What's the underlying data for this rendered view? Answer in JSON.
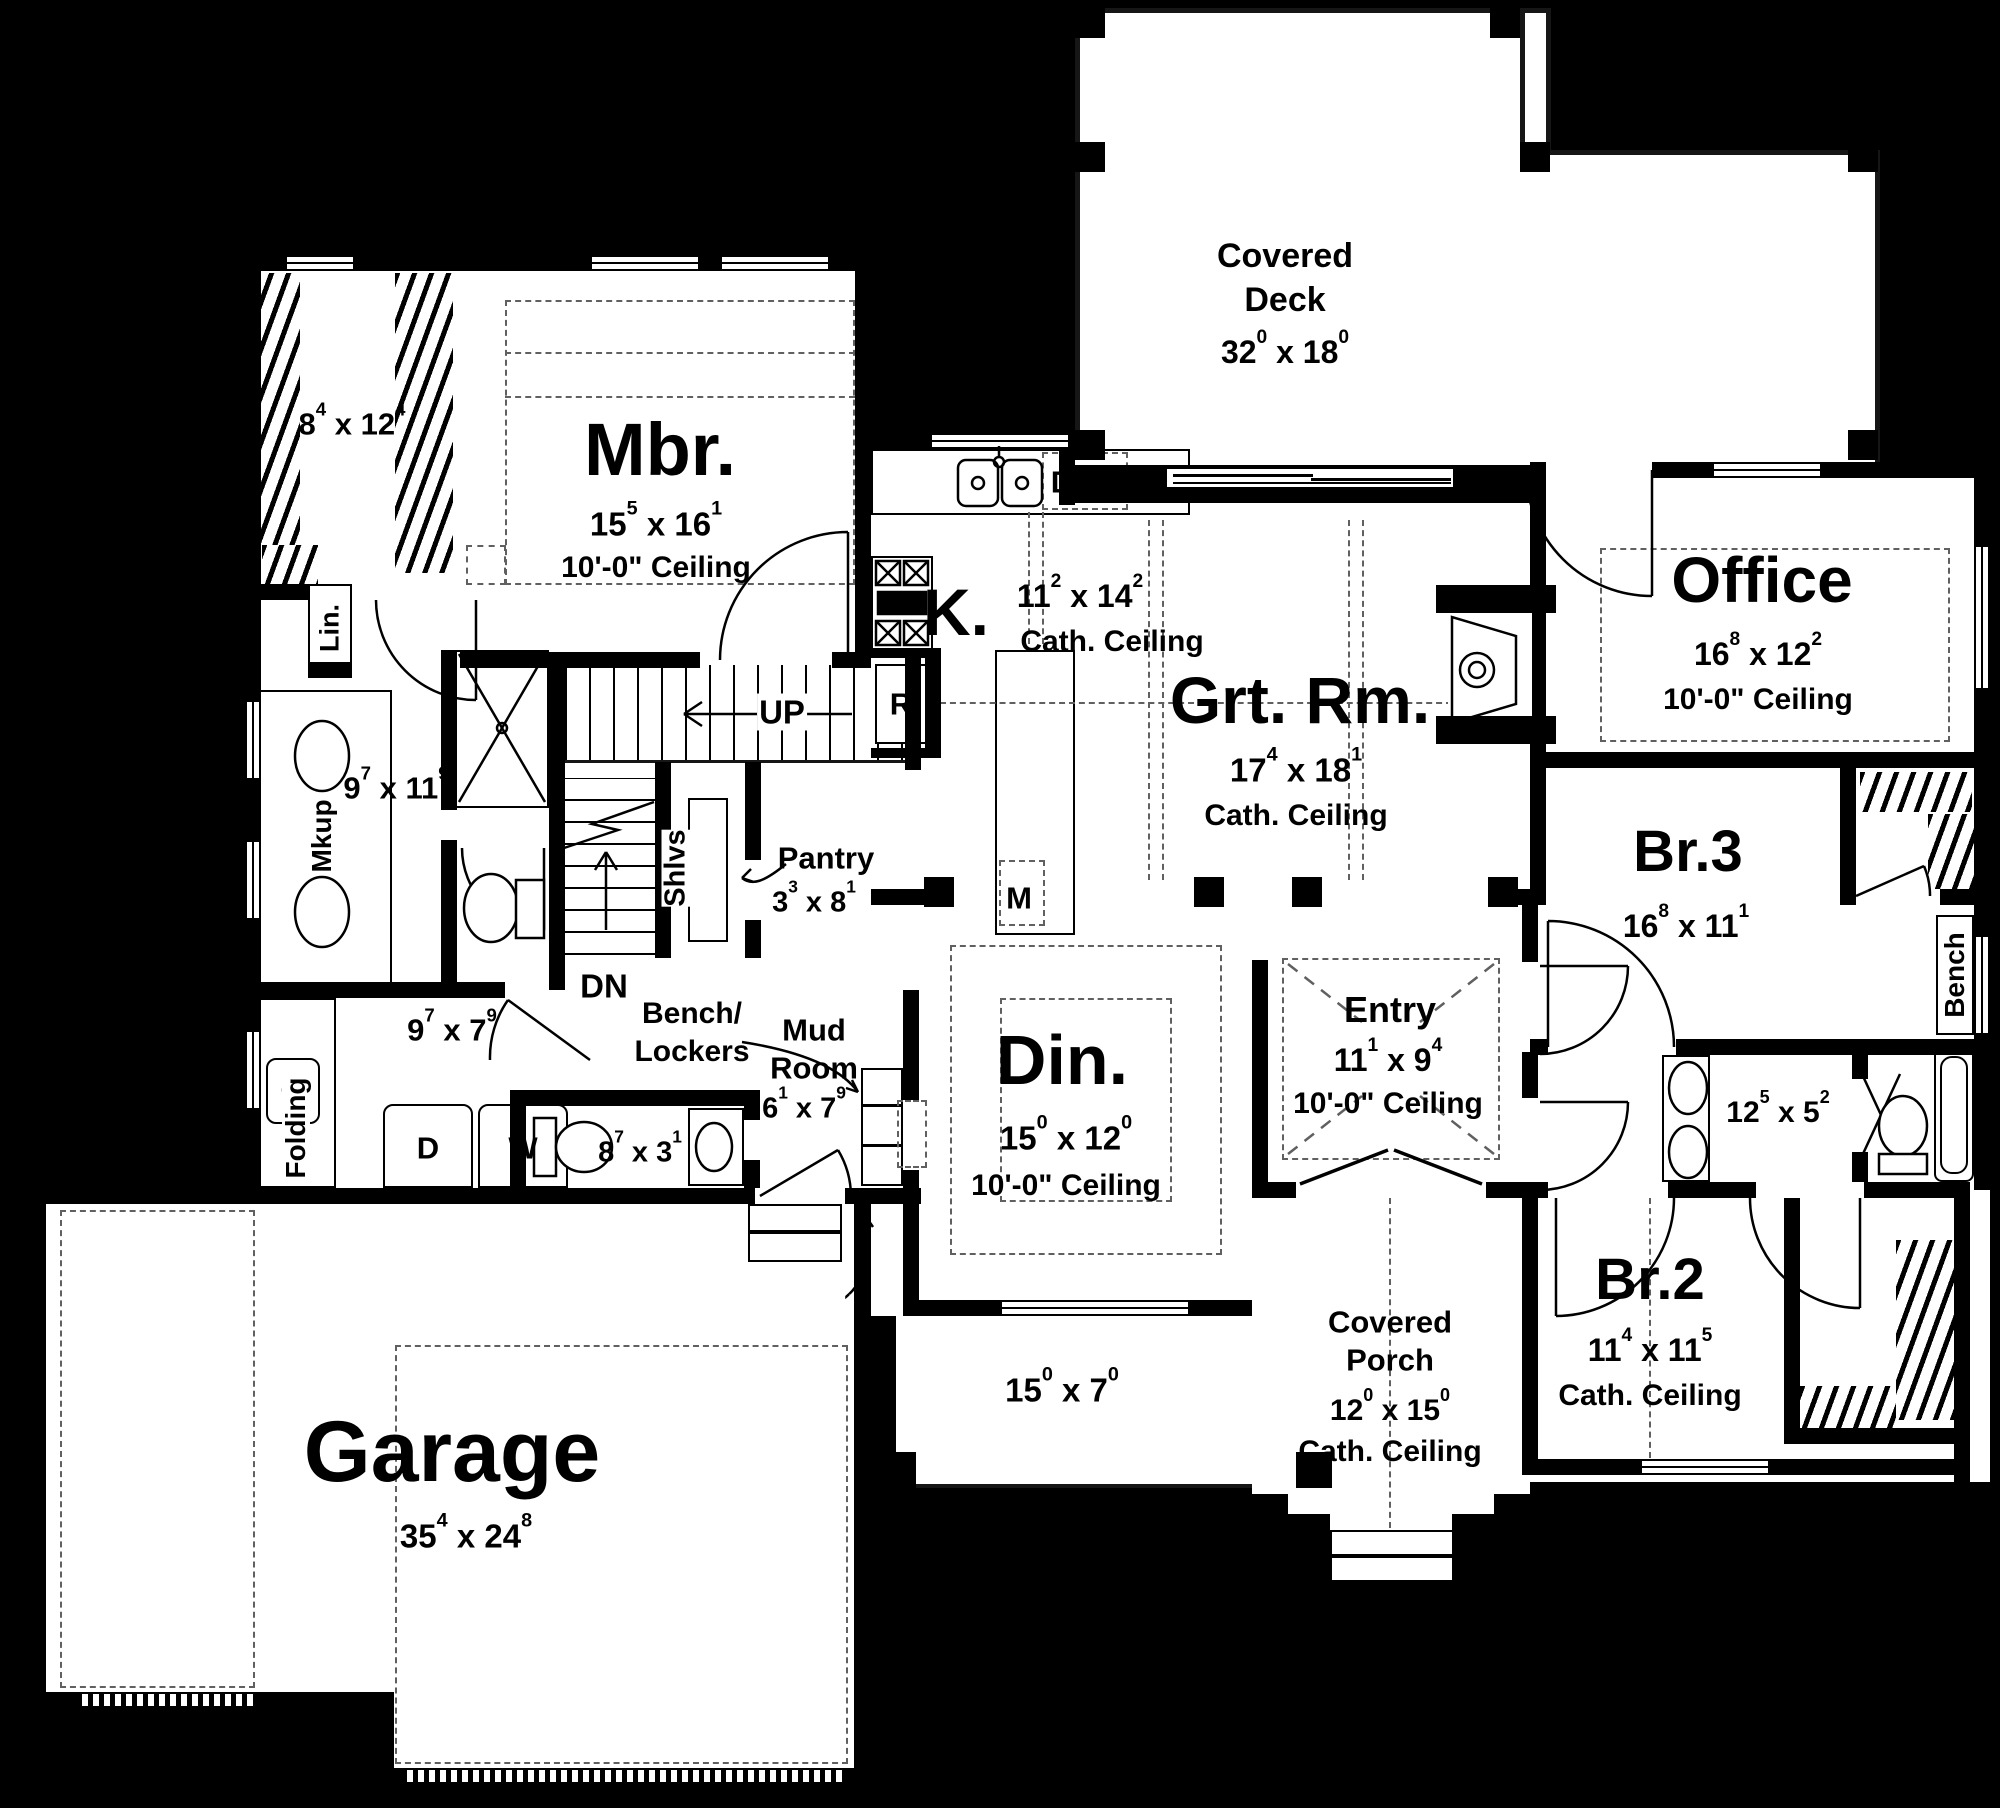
{
  "plan_colors": {
    "background": "#000000",
    "walls": "#000000",
    "floor": "#ffffff"
  },
  "rooms": {
    "deck": {
      "l1": "Covered",
      "l2": "Deck",
      "dim": {
        "a": "32",
        "sa": "0",
        "x": "x",
        "b": "18",
        "sb": "0"
      }
    },
    "mbr": {
      "name": "Mbr.",
      "dim": {
        "a": "15",
        "sa": "5",
        "x": "x",
        "b": "16",
        "sb": "1"
      },
      "ceil": "10'-0\" Ceiling"
    },
    "mbr_closet": {
      "dim": {
        "a": "8",
        "sa": "4",
        "x": "x",
        "b": "12",
        "sb": "4"
      }
    },
    "lin": {
      "name": "Lin."
    },
    "mbath": {
      "mkup": "Mkup",
      "dim": {
        "a": "9",
        "sa": "7",
        "x": "x",
        "b": "11",
        "sb": "9"
      }
    },
    "stairs": {
      "up": "UP",
      "dn": "DN"
    },
    "pantry": {
      "name": "Pantry",
      "shlvs": "Shlvs",
      "dim": {
        "a": "3",
        "sa": "3",
        "x": "x",
        "b": "8",
        "sb": "1"
      }
    },
    "kitchen": {
      "name": "K.",
      "dim": {
        "a": "11",
        "sa": "2",
        "x": "x",
        "b": "14",
        "sb": "2"
      },
      "ceil": "Cath. Ceiling",
      "dw": "D",
      "fridge": "R",
      "micro": "M"
    },
    "grt": {
      "name": "Grt. Rm.",
      "dim": {
        "a": "17",
        "sa": "4",
        "x": "x",
        "b": "18",
        "sb": "1"
      },
      "ceil": "Cath. Ceiling"
    },
    "office": {
      "name": "Office",
      "dim": {
        "a": "16",
        "sa": "8",
        "x": "x",
        "b": "12",
        "sb": "2"
      },
      "ceil": "10'-0\" Ceiling"
    },
    "br3": {
      "name": "Br.3",
      "dim": {
        "a": "16",
        "sa": "8",
        "x": "x",
        "b": "11",
        "sb": "1"
      },
      "bench": "Bench"
    },
    "bath2": {
      "dim": {
        "a": "12",
        "sa": "5",
        "x": "x",
        "b": "5",
        "sb": "2"
      }
    },
    "br2": {
      "name": "Br.2",
      "dim": {
        "a": "11",
        "sa": "4",
        "x": "x",
        "b": "11",
        "sb": "5"
      },
      "ceil": "Cath. Ceiling"
    },
    "din": {
      "name": "Din.",
      "dim": {
        "a": "15",
        "sa": "0",
        "x": "x",
        "b": "12",
        "sb": "0"
      },
      "ceil": "10'-0\" Ceiling"
    },
    "entry": {
      "name": "Entry",
      "dim": {
        "a": "11",
        "sa": "1",
        "x": "x",
        "b": "9",
        "sb": "4"
      },
      "ceil": "10'-0\" Ceiling"
    },
    "laundry": {
      "folding": "Folding",
      "dim": {
        "a": "9",
        "sa": "7",
        "x": "x",
        "b": "7",
        "sb": "9"
      },
      "d": "D",
      "w": "W"
    },
    "powder": {
      "dim": {
        "a": "8",
        "sa": "7",
        "x": "x",
        "b": "3",
        "sb": "1"
      }
    },
    "mud": {
      "l1": "Mud",
      "l2": "Room",
      "dim": {
        "a": "6",
        "sa": "1",
        "x": "x",
        "b": "7",
        "sb": "9"
      }
    },
    "lockers": {
      "l1": "Bench/",
      "l2": "Lockers"
    },
    "catchall": {
      "name": "Catch-All"
    },
    "garage": {
      "name": "Garage",
      "dim": {
        "a": "35",
        "sa": "4",
        "x": "x",
        "b": "24",
        "sb": "8"
      }
    },
    "porch_small": {
      "dim": {
        "a": "15",
        "sa": "0",
        "x": "x",
        "b": "7",
        "sb": "0"
      }
    },
    "porch": {
      "l1": "Covered",
      "l2": "Porch",
      "dim": {
        "a": "12",
        "sa": "0",
        "x": "x",
        "b": "15",
        "sb": "0"
      },
      "ceil": "Cath. Ceiling"
    }
  }
}
